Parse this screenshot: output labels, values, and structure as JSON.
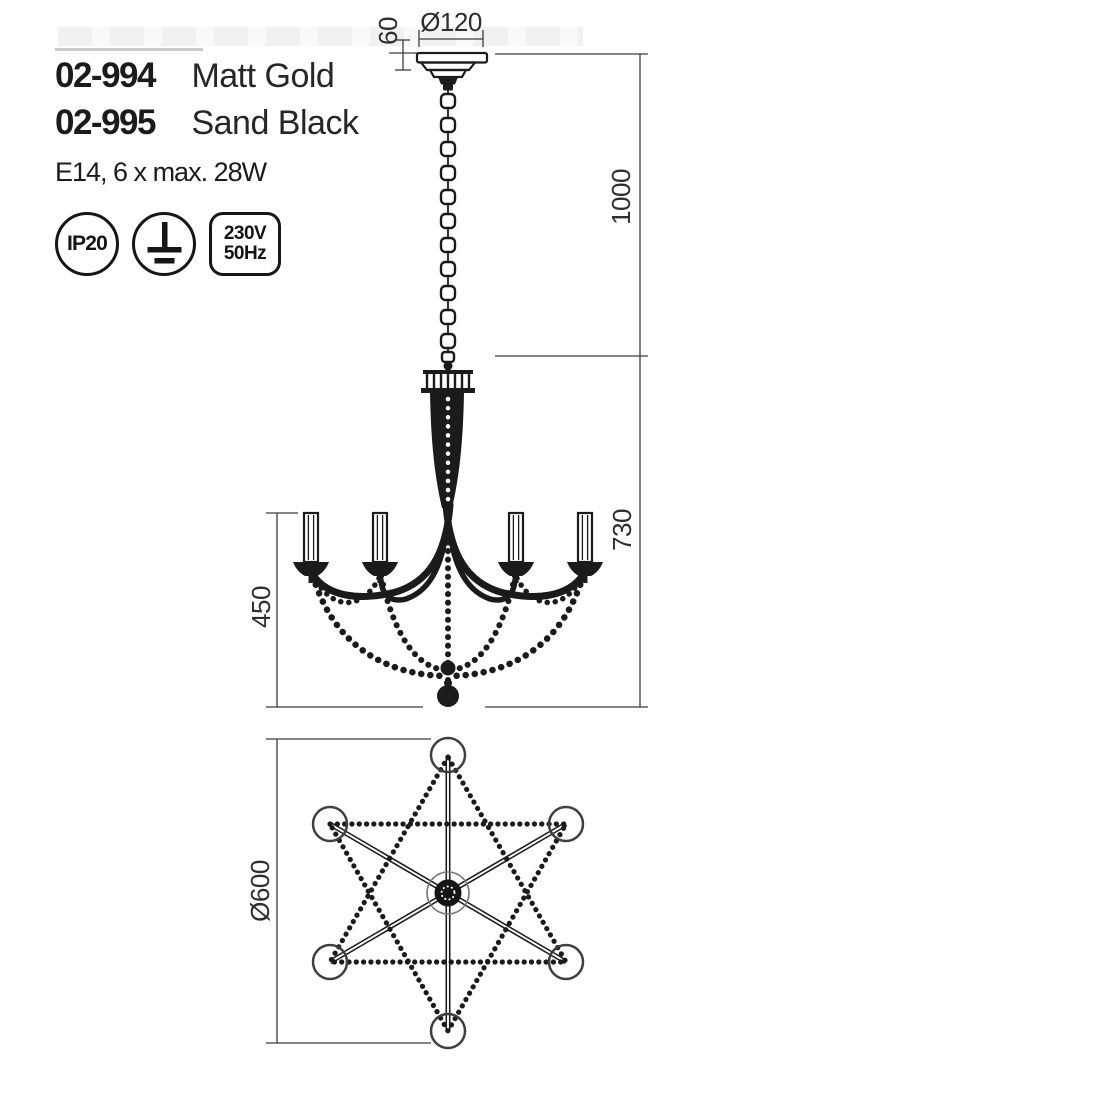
{
  "products": [
    {
      "code": "02-994",
      "finish": "Matt Gold"
    },
    {
      "code": "02-995",
      "finish": "Sand Black"
    }
  ],
  "lamp_info": "E14, 6 x max. 28W",
  "badges": {
    "ip_rating": "IP20",
    "earth_icon": "protective-earth-icon",
    "voltage": "230V",
    "frequency": "50Hz"
  },
  "dimensions": {
    "canopy_diameter": "Ø120",
    "canopy_height": "60",
    "suspension_length": "1000",
    "body_height": "730",
    "arm_section_height": "450",
    "fixture_diameter": "Ø600"
  },
  "colors": {
    "line": "#1b1b1b",
    "dimension_line": "#3c3c3c",
    "text": "#1c1c1c",
    "background": "#ffffff"
  }
}
